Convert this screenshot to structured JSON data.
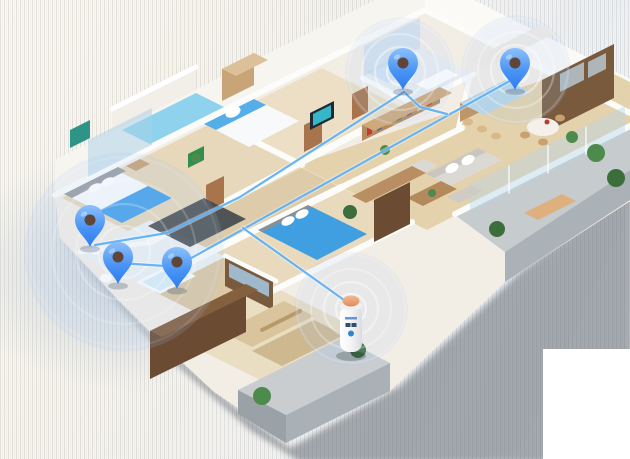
{
  "meta": {
    "description": "Isometric 3D apartment floor plan with five blue location pins, wireless signal rings, blue connection lines and a smart home hub cylinder on the balcony",
    "canvas": {
      "w": 630,
      "h": 459
    }
  },
  "palette": {
    "pin_blue_light": "#8cc0fb",
    "pin_blue_dark": "#2d7cf0",
    "pin_hole": "#5f4638",
    "line_blue": "#5fb0f5",
    "ring_white": "#ffffff",
    "glow_fill": "rgba(165,200,250,0.14)",
    "hub_dome": "#f0a97e",
    "wood_floor": "#e4d2ac",
    "shadow": "#596169",
    "wall_white": "#fcfcfa"
  },
  "background": {
    "white_patch": {
      "x": 543,
      "y": 349,
      "w": 87,
      "h": 110
    }
  },
  "icons": [
    {
      "name": "map-pin-icon",
      "count": 5
    },
    {
      "name": "wifi-ripple-rings-icon",
      "count": 4
    },
    {
      "name": "smart-hub-cylinder-icon",
      "count": 1
    }
  ],
  "scene": [
    {
      "k": "poly",
      "n": "apartment-shadow",
      "pts": "58,238 160,350 250,430 300,462 470,462 632,462 632,190 520,272 400,386 290,448 240,412 152,336",
      "f": "#596169",
      "o": 0.5,
      "blur": true
    },
    {
      "k": "poly",
      "n": "floor-slab",
      "pts": "55,195 425,10 632,114 632,200 505,282 390,391 286,443 238,408 214,392 152,334 118,300 92,272 60,238",
      "f": "#f3eee5"
    },
    {
      "k": "poly",
      "n": "facade-face-nw",
      "pts": "55,196 425,11 425,-25 55,160",
      "f": "#f7f5f0"
    },
    {
      "k": "poly",
      "n": "facade-face-ne",
      "pts": "425,11 632,115 632,80 425,-25",
      "f": "#fbfaf6"
    },
    {
      "k": "poly",
      "n": "balcony2-parapet",
      "pts": "112,132 196,90 196,66 112,108",
      "f": "#f2efe9"
    },
    {
      "k": "poly",
      "n": "balcony2-pool-floor",
      "pts": "122,130 196,93 224,107 150,144",
      "f": "#8ed2ee"
    },
    {
      "k": "line",
      "n": "balcony2-rail",
      "pts": "112,109 196,67",
      "s": "#ffffff",
      "w": 5
    },
    {
      "k": "poly",
      "n": "bedroom1-floor",
      "pts": "62,198 212,123 302,168 152,243",
      "f": "#e7d8bb"
    },
    {
      "k": "poly",
      "n": "bedroom2-floor",
      "pts": "212,123 322,68 407,110 297,165",
      "f": "#ecdfc5"
    },
    {
      "k": "poly",
      "n": "corridor-floor",
      "pts": "152,243 302,168 342,188 192,263",
      "f": "#ddcba9"
    },
    {
      "k": "poly",
      "n": "living-kitchen-floor",
      "pts": "297,165 592,63 672,103 427,230",
      "f": "#e4d2ac"
    },
    {
      "k": "poly",
      "n": "bathroom1-floor",
      "pts": "362,78 422,48 474,74 414,104",
      "f": "#e9edef"
    },
    {
      "k": "poly",
      "n": "right-balcony-floor",
      "pts": "455,215 630,127 630,170 505,252",
      "f": "#c6cbce"
    },
    {
      "k": "poly",
      "n": "right-balcony-face",
      "pts": "630,170 505,252 505,282 630,200",
      "f": "#aab2b8"
    },
    {
      "k": "poly",
      "n": "bedroom3-floor",
      "pts": "192,263 342,188 412,223 262,298",
      "f": "#e9dabd"
    },
    {
      "k": "poly",
      "n": "bathroom2-floor",
      "pts": "80,255 150,220 225,257 155,292",
      "f": "#eef1f2"
    },
    {
      "k": "poly",
      "n": "closet-floor",
      "pts": "155,292 225,257 275,282 205,317",
      "f": "#dcc8a4"
    },
    {
      "k": "poly",
      "n": "bedroom4-floor",
      "pts": "170,335 270,285 360,330 260,380",
      "f": "#e9ddc2"
    },
    {
      "k": "poly",
      "n": "south-balcony-floor",
      "pts": "238,390 342,338 390,363 286,415",
      "f": "#c9cdd0"
    },
    {
      "k": "poly",
      "n": "south-balcony-face",
      "pts": "390,363 286,415 286,443 390,391",
      "f": "#a9b1b7"
    },
    {
      "k": "poly",
      "n": "south-balcony-corner-face",
      "pts": "238,390 286,415 286,443 238,414",
      "f": "#9aa2a8"
    },
    {
      "k": "line",
      "n": "wall-facade-nw",
      "pts": "55,195 425,10",
      "s": "#fcfcfa",
      "w": 6
    },
    {
      "k": "line",
      "n": "wall-facade-ne",
      "pts": "425,10 630,113",
      "s": "#fcfcfa",
      "w": 6
    },
    {
      "k": "line",
      "n": "wall-bed1-bed2",
      "pts": "212,120 302,165",
      "s": "#fcfcfa",
      "w": 6
    },
    {
      "k": "line",
      "n": "wall-spine-nw",
      "pts": "150,242 412,104",
      "s": "#fcfcfa",
      "w": 7
    },
    {
      "k": "line",
      "n": "wall-bath1-sw",
      "pts": "362,78 414,104",
      "s": "#fcfcfa",
      "w": 5
    },
    {
      "k": "line",
      "n": "wall-bath1-se",
      "pts": "414,104 474,74",
      "s": "#fcfcfa",
      "w": 5
    },
    {
      "k": "line",
      "n": "wall-corridor-se",
      "pts": "190,262 342,187",
      "s": "#fcfcfa",
      "w": 7
    },
    {
      "k": "line",
      "n": "wall-living-nw",
      "pts": "342,187 462,128",
      "s": "#fcfcfa",
      "w": 6
    },
    {
      "k": "line",
      "n": "wall-kitchen-w",
      "pts": "458,130 470,76",
      "s": "#fcfcfa",
      "w": 5
    },
    {
      "k": "line",
      "n": "wall-living-balcony",
      "pts": "455,214 630,126",
      "s": "#fcfcfa",
      "w": 6
    },
    {
      "k": "line",
      "n": "wall-bathroom2-nw",
      "pts": "80,252 152,242",
      "s": "#fcfcfa",
      "w": 5
    },
    {
      "k": "line",
      "n": "wall-bed3-se",
      "pts": "262,296 412,222",
      "s": "#fcfcfa",
      "w": 6
    },
    {
      "k": "line",
      "n": "wall-bed4-nw",
      "pts": "165,332 270,282",
      "s": "#fcfcfa",
      "w": 6
    },
    {
      "k": "line",
      "n": "wall-closet-se",
      "pts": "225,256 276,281",
      "s": "#fcfcfa",
      "w": 5
    },
    {
      "k": "poly",
      "n": "door-bedroom2",
      "pts": "304,152 322,143 322,116 304,125",
      "f": "#a8744b"
    },
    {
      "k": "poly",
      "n": "door-corridor",
      "pts": "206,212 224,203 224,176 206,185",
      "f": "#a8744b"
    },
    {
      "k": "poly",
      "n": "door-hall",
      "pts": "352,120 368,112 368,86 352,94",
      "f": "#a8744b"
    },
    {
      "k": "poly",
      "n": "green-wall-art",
      "pts": "188,168 204,160 204,146 188,154",
      "f": "#2e8f4e"
    },
    {
      "k": "poly",
      "n": "bedroom1-window-glass",
      "pts": "88,178 152,146 152,108 88,140",
      "f": "rgba(170,208,230,0.5)"
    },
    {
      "k": "line",
      "n": "bedroom1-window-frame",
      "pts": "88,178 152,146",
      "s": "#ffffff",
      "w": 2
    },
    {
      "k": "poly",
      "n": "living-balcony-glass",
      "pts": "470,212 625,134 625,106 470,184",
      "f": "rgba(180,212,234,0.42)"
    },
    {
      "k": "line",
      "n": "glass-mullion-1",
      "pts": "509,193 509,166",
      "s": "#ffffff",
      "w": 1.5,
      "o": 0.8
    },
    {
      "k": "line",
      "n": "glass-mullion-2",
      "pts": "548,173 548,146",
      "s": "#ffffff",
      "w": 1.5,
      "o": 0.8
    },
    {
      "k": "line",
      "n": "glass-mullion-3",
      "pts": "586,154 586,127",
      "s": "#ffffff",
      "w": 1.5,
      "o": 0.8
    },
    {
      "k": "poly",
      "n": "bathroom1-tile-wall",
      "pts": "364,76 420,48 420,18 364,46",
      "f": "#d7e2ec"
    },
    {
      "k": "poly",
      "n": "bathroom1-shower-glass",
      "pts": "366,72 394,58 416,69 388,83",
      "f": "rgba(190,220,240,0.55)"
    },
    {
      "k": "poly",
      "n": "bathroom1-vanity",
      "pts": "416,84 446,69 458,75 428,90",
      "f": "#ffffff"
    },
    {
      "k": "ell",
      "n": "bathroom1-toilet",
      "cx": 396,
      "cy": 94,
      "rx": 6,
      "ry": 4,
      "f": "#ffffff"
    },
    {
      "k": "poly",
      "n": "wardrobe2-front",
      "pts": "222,101 254,85 254,53 222,69",
      "f": "#c8a477"
    },
    {
      "k": "poly",
      "n": "wardrobe2-top",
      "pts": "222,69 254,53 268,60 236,76",
      "f": "#dcc09a"
    },
    {
      "k": "poly",
      "n": "bed2-duvet",
      "pts": "204,124 254,99 299,121 249,147",
      "f": "#f8f9fa"
    },
    {
      "k": "poly",
      "n": "bed2-blue-sheet",
      "pts": "204,124 254,99 266,105 216,130",
      "f": "#55aee8"
    },
    {
      "k": "ell",
      "n": "bed2-pillow",
      "cx": 233,
      "cy": 112,
      "rx": 8,
      "ry": 5,
      "f": "#ffffff",
      "rot": -26
    },
    {
      "k": "poly",
      "n": "bedroom2-tv-frame",
      "pts": "310,130 334,118 334,101 310,113",
      "f": "#1d2a33"
    },
    {
      "k": "poly",
      "n": "bedroom2-tv-screen",
      "pts": "313,126 331,117 331,105 313,114",
      "f": "#35b6c9"
    },
    {
      "k": "poly",
      "n": "kitchen-counter-north",
      "pts": "470,60 540,25 556,33 486,68",
      "f": "#f1ece4"
    },
    {
      "k": "poly",
      "n": "kitchen-appliance-wall",
      "pts": "542,80 614,44 614,98 542,134",
      "f": "#7a5a3d"
    },
    {
      "k": "poly",
      "n": "kitchen-oven-1",
      "pts": "560,92 584,80 584,62 560,74",
      "f": "#aeb6ba"
    },
    {
      "k": "poly",
      "n": "kitchen-oven-2",
      "pts": "588,78 606,69 606,53 588,62",
      "f": "#aeb6ba"
    },
    {
      "k": "poly",
      "n": "kitchen-island-base",
      "pts": "460,103 506,80 506,99 460,122",
      "f": "#bd9769"
    },
    {
      "k": "poly",
      "n": "kitchen-island-top",
      "pts": "460,103 506,80 530,92 484,115",
      "f": "#b9d7e6"
    },
    {
      "k": "ell",
      "n": "kitchen-stool-1",
      "cx": 468,
      "cy": 122,
      "rx": 5,
      "ry": 3.5,
      "f": "#d7b98c"
    },
    {
      "k": "ell",
      "n": "kitchen-stool-2",
      "cx": 482,
      "cy": 129,
      "rx": 5,
      "ry": 3.5,
      "f": "#d7b98c"
    },
    {
      "k": "ell",
      "n": "kitchen-stool-3",
      "cx": 496,
      "cy": 136,
      "rx": 5,
      "ry": 3.5,
      "f": "#d7b98c"
    },
    {
      "k": "ell",
      "n": "dining-table",
      "cx": 543,
      "cy": 127,
      "rx": 16,
      "ry": 9,
      "f": "#f5f1ea"
    },
    {
      "k": "ell",
      "n": "dining-chair-1",
      "cx": 525,
      "cy": 135,
      "rx": 5,
      "ry": 3.5,
      "f": "#caa06e"
    },
    {
      "k": "ell",
      "n": "dining-chair-2",
      "cx": 543,
      "cy": 142,
      "rx": 5,
      "ry": 3.5,
      "f": "#caa06e"
    },
    {
      "k": "ell",
      "n": "dining-chair-3",
      "cx": 560,
      "cy": 118,
      "rx": 5,
      "ry": 3.5,
      "f": "#caa06e"
    },
    {
      "k": "ell",
      "n": "dining-plant-pot",
      "cx": 547,
      "cy": 122,
      "rx": 2.5,
      "ry": 2.5,
      "f": "#c0392b"
    },
    {
      "k": "poly",
      "n": "bookshelf-front",
      "pts": "362,141 440,103 440,87 362,125",
      "f": "#b48a5e"
    },
    {
      "k": "books",
      "n": 7,
      "x": 367,
      "y": 136,
      "dx": 10,
      "colors": [
        "#c23b2e",
        "#2e6fb4",
        "#e09b2d",
        "#4d8b4d",
        "#7a4fa0",
        "#d0d4d8",
        "#c23b2e"
      ]
    },
    {
      "k": "poly",
      "n": "bookshelf-top",
      "pts": "362,125 440,87 452,93 374,131",
      "f": "#cfa97b"
    },
    {
      "k": "poly",
      "n": "sofa-body",
      "pts": "426,174 478,148 502,160 450,186",
      "f": "#dbd9d4"
    },
    {
      "k": "poly",
      "n": "sofa-back",
      "pts": "426,174 478,148 486,152 434,178",
      "f": "#c9c6c0"
    },
    {
      "k": "ell",
      "n": "sofa-cushion-1",
      "cx": 452,
      "cy": 168,
      "rx": 7,
      "ry": 4.5,
      "f": "#ffffff",
      "rot": -26
    },
    {
      "k": "ell",
      "n": "sofa-cushion-2",
      "cx": 468,
      "cy": 160,
      "rx": 7,
      "ry": 4.5,
      "f": "#ffffff",
      "rot": -26
    },
    {
      "k": "poly",
      "n": "armchair",
      "pts": "396,173 424,159 438,166 410,180",
      "f": "#dbd9d4"
    },
    {
      "k": "poly",
      "n": "ottoman",
      "pts": "447,197 471,185 483,191 459,203",
      "f": "#cfccc6"
    },
    {
      "k": "poly",
      "n": "coffee-table",
      "pts": "407,198 441,181 457,189 423,206",
      "f": "#b4895c"
    },
    {
      "k": "ell",
      "n": "coffee-table-plant",
      "cx": 432,
      "cy": 193,
      "rx": 4,
      "ry": 4,
      "f": "#4d8b4d"
    },
    {
      "k": "poly",
      "n": "tv-cabinet-living",
      "pts": "374,200 410,182 410,224 374,242",
      "f": "#6b4c33"
    },
    {
      "k": "ell",
      "n": "living-plant-1",
      "cx": 350,
      "cy": 212,
      "rx": 7,
      "ry": 7,
      "f": "#3c6e3c"
    },
    {
      "k": "ell",
      "n": "living-plant-2",
      "cx": 385,
      "cy": 150,
      "rx": 5,
      "ry": 5,
      "f": "#4d8b4d"
    },
    {
      "k": "poly",
      "n": "balcony-lounge-chair",
      "pts": "524,213 562,194 576,201 538,220",
      "f": "#ddb07e"
    },
    {
      "k": "ell",
      "n": "balcony-plant-1",
      "cx": 497,
      "cy": 229,
      "rx": 8,
      "ry": 8,
      "f": "#3c6e3c"
    },
    {
      "k": "ell",
      "n": "balcony-plant-2",
      "cx": 596,
      "cy": 153,
      "rx": 9,
      "ry": 9,
      "f": "#4d8b4d"
    },
    {
      "k": "ell",
      "n": "balcony-plant-3",
      "cx": 616,
      "cy": 178,
      "rx": 9,
      "ry": 9,
      "f": "#3c6e3c"
    },
    {
      "k": "ell",
      "n": "balcony-plant-4",
      "cx": 572,
      "cy": 137,
      "rx": 6,
      "ry": 6,
      "f": "#4d8b4d"
    },
    {
      "k": "poly",
      "n": "bed1-headboard",
      "pts": "64,194 118,167 126,171 72,198",
      "f": "#9ba0a5"
    },
    {
      "k": "poly",
      "n": "bed1-duvet",
      "pts": "72,198 122,173 172,198 122,223",
      "f": "#fafbfc"
    },
    {
      "k": "poly",
      "n": "bed1-blue-blanket",
      "pts": "98,211 148,186 172,198 122,223",
      "f": "#4aa3e8"
    },
    {
      "k": "ell",
      "n": "bed1-pillow-1",
      "cx": 95,
      "cy": 188,
      "rx": 7,
      "ry": 4,
      "f": "#ffffff",
      "rot": -26
    },
    {
      "k": "ell",
      "n": "bed1-pillow-2",
      "cx": 108,
      "cy": 182,
      "rx": 7,
      "ry": 4,
      "f": "#ffffff",
      "rot": -26
    },
    {
      "k": "poly",
      "n": "bedroom1-rug",
      "pts": "148,226 204,198 246,219 190,247",
      "f": "#41474d",
      "o": 0.9
    },
    {
      "k": "poly",
      "n": "bedroom1-wall-art",
      "pts": "70,148 90,138 90,120 70,130",
      "f": "#2f9488"
    },
    {
      "k": "poly",
      "n": "nightstand",
      "pts": "126,166 140,159 150,164 136,171",
      "f": "#c8a477"
    },
    {
      "k": "ell",
      "n": "corridor-plant",
      "cx": 196,
      "cy": 158,
      "rx": 5,
      "ry": 5,
      "f": "#4d8b4d"
    },
    {
      "k": "poly",
      "n": "bed3-headboard",
      "pts": "258,230 308,205 316,209 266,234",
      "f": "#8a8f94"
    },
    {
      "k": "poly",
      "n": "bed3-blue-duvet",
      "pts": "262,232 312,207 367,234 317,260",
      "f": "#3f9fe0"
    },
    {
      "k": "ell",
      "n": "bed3-pillow-1",
      "cx": 288,
      "cy": 221,
      "rx": 7,
      "ry": 4,
      "f": "#ffffff",
      "rot": -26
    },
    {
      "k": "ell",
      "n": "bed3-pillow-2",
      "cx": 302,
      "cy": 214,
      "rx": 7,
      "ry": 4,
      "f": "#ffffff",
      "rot": -26
    },
    {
      "k": "poly",
      "n": "bedroom3-dresser",
      "pts": "352,196 412,166 426,173 366,203",
      "f": "#b98e62"
    },
    {
      "k": "poly",
      "n": "bathroom2-tub",
      "pts": "136,282 172,264 196,276 160,294",
      "f": "#fbfcfd"
    },
    {
      "k": "poly",
      "n": "bathroom2-tub-water",
      "pts": "142,282 170,268 188,277 160,291",
      "f": "#dbeef5"
    },
    {
      "k": "ell",
      "n": "bathroom2-toilet",
      "cx": 106,
      "cy": 278,
      "rx": 6,
      "ry": 4.5,
      "f": "#ffffff"
    },
    {
      "k": "ell",
      "n": "bathroom2-sink",
      "cx": 95,
      "cy": 251,
      "rx": 5,
      "ry": 3.5,
      "f": "#ffffff"
    },
    {
      "k": "poly",
      "n": "closet-shelves",
      "pts": "225,258 273,282 273,310 225,286",
      "f": "#7a5a3d"
    },
    {
      "k": "poly",
      "n": "closet-clothes",
      "pts": "229,263 269,283 269,297 229,277",
      "f": "#9fb8cc"
    },
    {
      "k": "poly",
      "n": "bedroom4-mat-1",
      "pts": "222,332 284,301 314,316 252,347",
      "f": "#d9c49e"
    },
    {
      "k": "poly",
      "n": "bedroom4-mat-2",
      "pts": "252,351 314,320 344,335 282,366",
      "f": "#cdb890"
    },
    {
      "k": "line",
      "n": "bedroom4-bolster",
      "pts": "262,330 300,311",
      "s": "#b89a6a",
      "w": 4
    },
    {
      "k": "poly",
      "n": "bedroom4-cabinet-face",
      "pts": "150,331 246,284 246,332 150,379",
      "f": "#6b4c33"
    },
    {
      "k": "poly",
      "n": "bedroom4-cabinet-top",
      "pts": "150,331 246,284 258,290 162,337",
      "f": "#84603f"
    },
    {
      "k": "ell",
      "n": "south-balcony-plant-1",
      "cx": 262,
      "cy": 396,
      "rx": 9,
      "ry": 9,
      "f": "#4d8b4d"
    },
    {
      "k": "ell",
      "n": "south-balcony-plant-2",
      "cx": 358,
      "cy": 350,
      "rx": 8,
      "ry": 8,
      "f": "#3c6e3c"
    },
    {
      "k": "glow",
      "n": "wifi-ripple-rings-bathroom",
      "cx": 400,
      "cy": 72,
      "r": [
        13,
        25,
        38,
        52
      ],
      "op": [
        0.55,
        0.42,
        0.3,
        0.18
      ]
    },
    {
      "k": "glow",
      "n": "wifi-ripple-rings-kitchen",
      "cx": 516,
      "cy": 70,
      "r": [
        13,
        25,
        38,
        52
      ],
      "op": [
        0.55,
        0.42,
        0.3,
        0.18
      ]
    },
    {
      "k": "glow",
      "n": "wifi-ripple-rings-southwest",
      "cx": 124,
      "cy": 252,
      "r": [
        26,
        48,
        72,
        95
      ],
      "op": [
        0.3,
        0.24,
        0.18,
        0.1
      ]
    },
    {
      "k": "glow",
      "n": "wifi-ripple-rings-hub",
      "cx": 351,
      "cy": 309,
      "r": [
        15,
        27,
        40,
        54
      ],
      "op": [
        0.5,
        0.38,
        0.26,
        0.15
      ]
    },
    {
      "k": "net",
      "n": "connection-line-kitchen-to-southwest",
      "pts": "515,78 177,266"
    },
    {
      "k": "net",
      "n": "connection-line-bathroom-link",
      "pts": "404,92 420,107 447,114"
    },
    {
      "k": "net",
      "n": "connection-line-branch-to-hub",
      "pts": "243,228 351,305"
    },
    {
      "k": "net",
      "n": "connection-line-bathroom-to-west",
      "pts": "404,92 240,197 167,233 95,245"
    },
    {
      "k": "net",
      "n": "connection-line-pinC-pinB",
      "pts": "180,267 120,263"
    },
    {
      "k": "hub",
      "n": "smart-hub-cylinder-icon",
      "cx": 351,
      "top": 301,
      "bodyY": 306,
      "bodyH": 46,
      "bodyW": 22
    },
    {
      "k": "pin",
      "n": "map-pin-icon-bedroom1",
      "tip": "90,247"
    },
    {
      "k": "pin",
      "n": "map-pin-icon-bathroom2",
      "tip": "118,284"
    },
    {
      "k": "pin",
      "n": "map-pin-icon-closet",
      "tip": "177,289"
    },
    {
      "k": "pin",
      "n": "map-pin-icon-bathroom1",
      "tip": "403,90"
    },
    {
      "k": "pin",
      "n": "map-pin-icon-kitchen",
      "tip": "515,90"
    }
  ]
}
